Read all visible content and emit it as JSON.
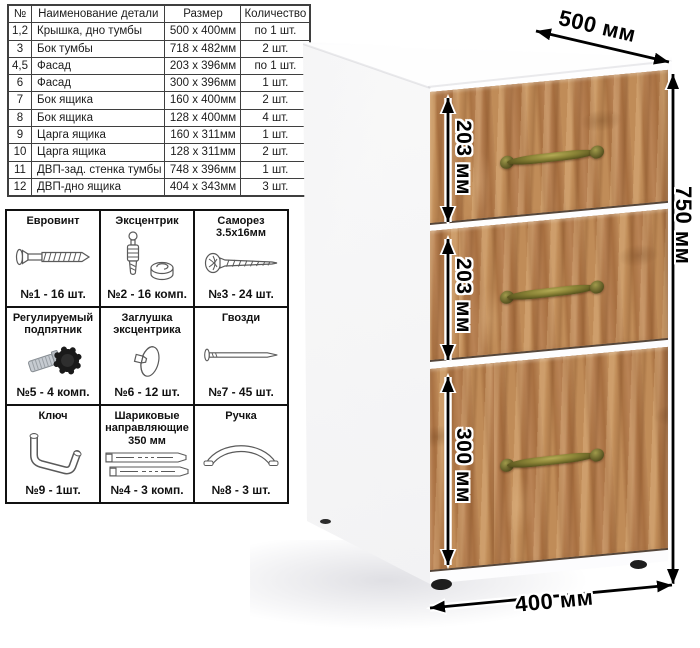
{
  "parts_table": {
    "headers": [
      "№",
      "Наименование детали",
      "Размер",
      "Количество"
    ],
    "rows": [
      [
        "1,2",
        "Крышка, дно тумбы",
        "500 х 400мм",
        "по 1 шт."
      ],
      [
        "3",
        "Бок тумбы",
        "718 х 482мм",
        "2 шт."
      ],
      [
        "4,5",
        "Фасад",
        "203 х 396мм",
        "по 1 шт."
      ],
      [
        "6",
        "Фасад",
        "300 х 396мм",
        "1 шт."
      ],
      [
        "7",
        "Бок ящика",
        "160 х 400мм",
        "2 шт."
      ],
      [
        "8",
        "Бок ящика",
        "128 х 400мм",
        "4 шт."
      ],
      [
        "9",
        "Царга ящика",
        "160 х 311мм",
        "1 шт."
      ],
      [
        "10",
        "Царга ящика",
        "128 х 311мм",
        "2 шт."
      ],
      [
        "11",
        "ДВП-зад. стенка тумбы",
        "748 х 396мм",
        "1 шт."
      ],
      [
        "12",
        "ДВП-дно ящика",
        "404 х 343мм",
        "3 шт."
      ]
    ]
  },
  "hardware": {
    "cells": [
      {
        "title": "Евровинт",
        "icon": "euro-screw-icon",
        "count": "№1 - 16 шт."
      },
      {
        "title": "Эксцентрик",
        "icon": "cam-bolt-icon",
        "count": "№2 - 16 комп."
      },
      {
        "title": "Саморез 3.5х16мм",
        "icon": "self-tapping-screw-icon",
        "count": "№3 - 24 шт."
      },
      {
        "title": "Регулируемый подпятник",
        "icon": "adjustable-foot-icon",
        "count": "№5 - 4 комп."
      },
      {
        "title": "Заглушка эксцентрика",
        "icon": "cam-cover-icon",
        "count": "№6 - 12 шт."
      },
      {
        "title": "Гвозди",
        "icon": "nail-icon",
        "count": "№7 - 45 шт."
      },
      {
        "title": "Ключ",
        "icon": "hex-key-icon",
        "count": "№9 - 1шт."
      },
      {
        "title": "Шариковые направляющие 350 мм",
        "icon": "ball-guides-icon",
        "count": "№4 - 3 комп."
      },
      {
        "title": "Ручка",
        "icon": "handle-icon",
        "count": "№8 - 3 шт."
      }
    ]
  },
  "cabinet": {
    "dims": {
      "depth": "500 мм",
      "height": "750 мм",
      "width": "400 мм"
    },
    "drawers": [
      {
        "label": "203 мм"
      },
      {
        "label": "203 мм"
      },
      {
        "label": "300 мм"
      }
    ]
  },
  "colors": {
    "wood": "#b5834f",
    "wood_dark": "#a06b3d",
    "handle_brass": "#7a7433",
    "dimension_black": "#000000",
    "cabinet_white": "#ffffff"
  }
}
